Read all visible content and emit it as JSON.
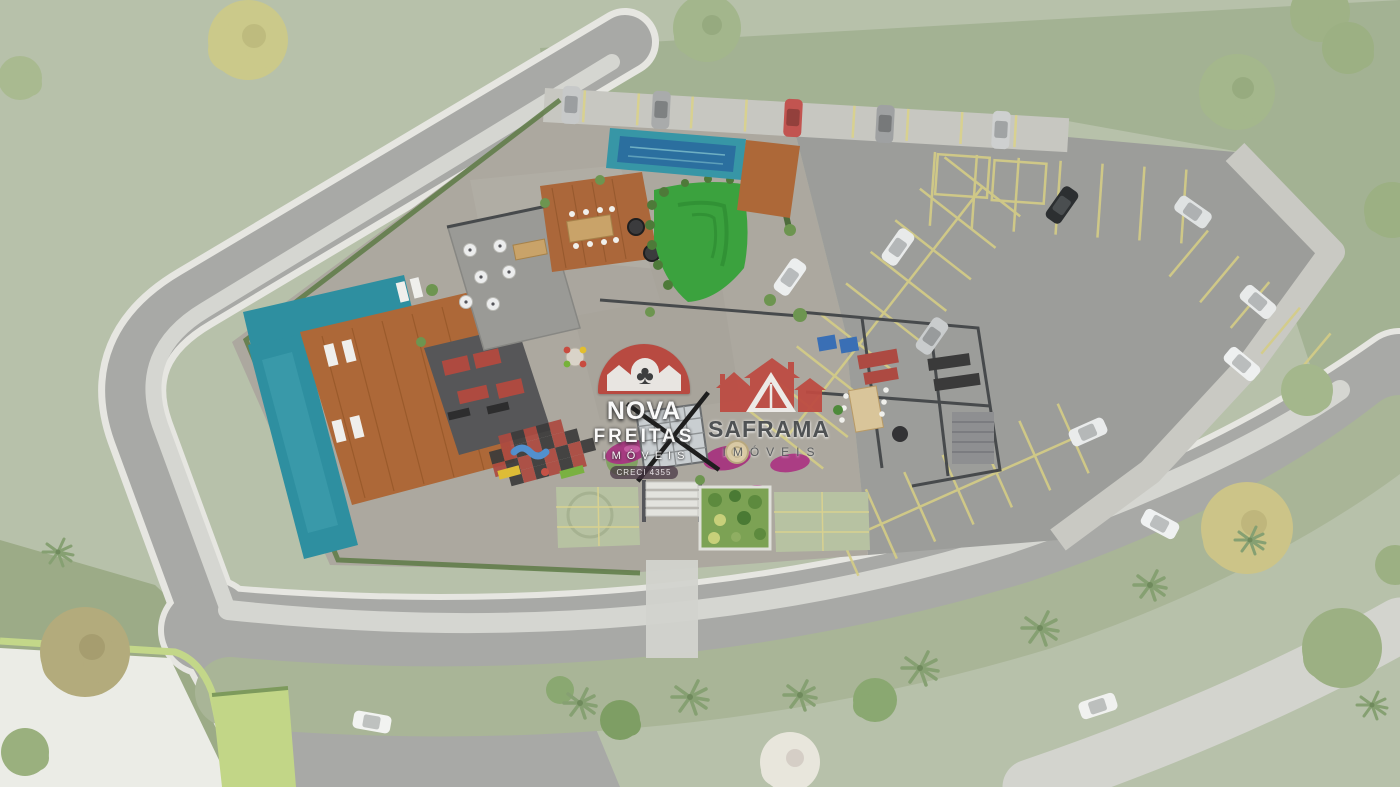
{
  "watermarks": {
    "nova_freitas": {
      "line1": "NOVA",
      "line2": "FREITAS",
      "line3": "IMÓVEIS",
      "badge": "CRECI 4355",
      "brand_red": "#b9453c",
      "clover_icon": "♣"
    },
    "saframa": {
      "line1": "SAFRAMA",
      "line2": "IMÓVEIS",
      "brand_red": "#bd4b42",
      "text_gray": "#4a4d50"
    }
  },
  "palette": {
    "grass": "#b7c1aa",
    "grass_dark": "#a3b293",
    "road": "#a8a9a6",
    "sidewalk": "#d5d6d1",
    "parking_tarmac": "#9c9d9a",
    "site_paving": "#aca89f",
    "pool_teal": "#2e8fa0",
    "pool_blue": "#2b6f9f",
    "wood_deck": "#ad6838",
    "lawn_green": "#3ba23e",
    "stall_yellow": "#d5cd86",
    "flower_magenta": "#a63a80",
    "checker_red": "#ad4a40",
    "checker_dark": "#3c3b3b",
    "tree_yellow": "#cbc98a",
    "tree_green": "#9cb083"
  }
}
